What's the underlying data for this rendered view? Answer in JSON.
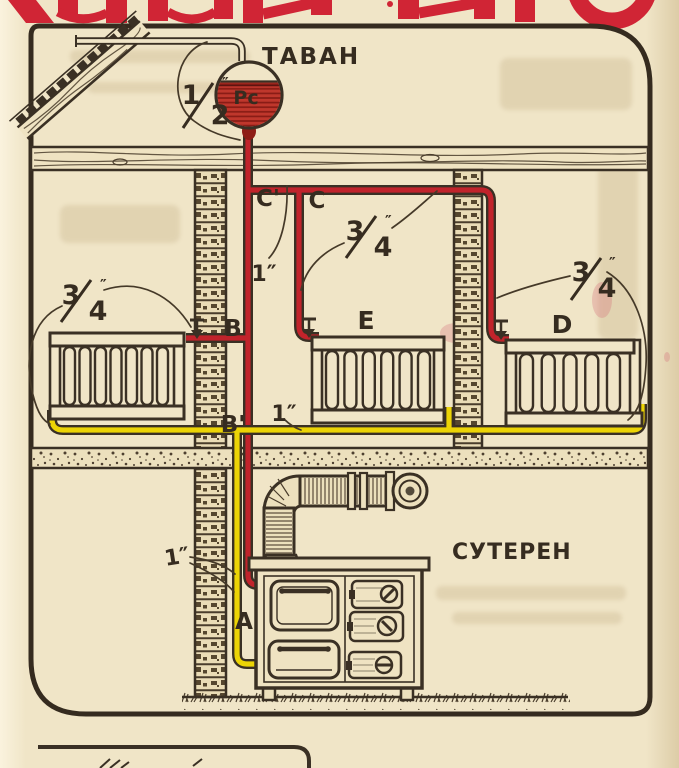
{
  "diagram": {
    "attic_label": "ТАВАН",
    "basement_label": "СУТЕРЕН",
    "tank_label": "Рс",
    "points": {
      "c_prime": "C'",
      "c": "C",
      "b": "B",
      "b_prime": "B'",
      "e": "E",
      "d": "D",
      "a": "A"
    },
    "pipe_sizes": {
      "half": {
        "num": "1",
        "den": "2",
        "unit": "″"
      },
      "three_quarter": {
        "num": "3",
        "den": "4",
        "unit": "″"
      },
      "one": "1″"
    },
    "colors": {
      "paper": "#f0e5c7",
      "ink": "#362c20",
      "supply_pipe_red": "#c1232b",
      "return_pipe_yellow": "#ecd405",
      "masthead_red": "#d02535"
    }
  }
}
